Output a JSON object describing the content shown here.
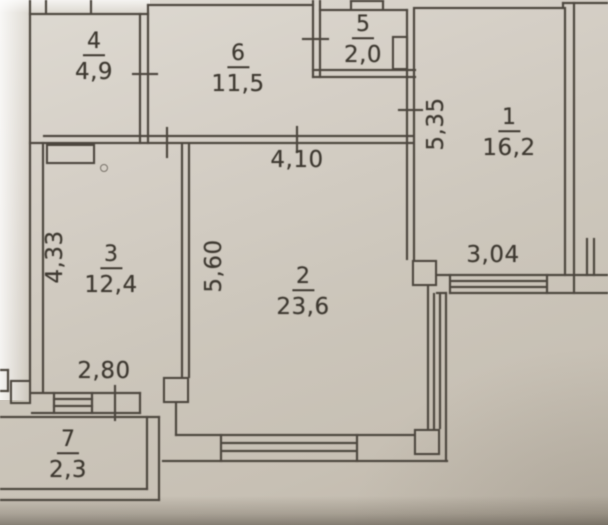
{
  "plan_title": "apartment-floor-plan",
  "rooms": {
    "r4": {
      "number": "4",
      "area": "4,9"
    },
    "r6": {
      "number": "6",
      "area": "11,5"
    },
    "r5": {
      "number": "5",
      "area": "2,0"
    },
    "r1": {
      "number": "1",
      "area": "16,2"
    },
    "r3": {
      "number": "3",
      "area": "12,4"
    },
    "r2": {
      "number": "2",
      "area": "23,6"
    },
    "r7": {
      "number": "7",
      "area": "2,3"
    }
  },
  "dimensions": {
    "room2_width": "4,10",
    "room1_depth": "5,35",
    "room3_depth": "4,33",
    "room2_depth": "5,60",
    "room3_width": "2,80",
    "room1_width": "3,04"
  },
  "colors": {
    "paper": "#cfc9bf",
    "line": "#4d473f",
    "text": "#3e3931"
  }
}
